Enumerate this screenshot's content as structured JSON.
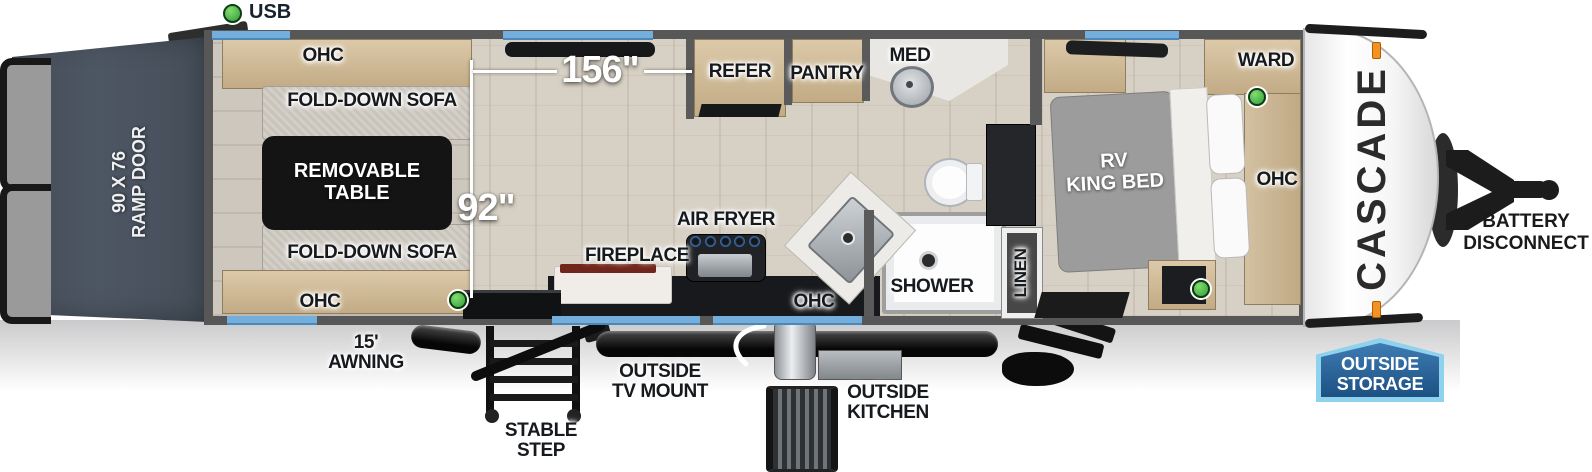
{
  "legend": {
    "usb_label": "USB"
  },
  "dimensions": {
    "main_width": "156\"",
    "garage_width": "92\""
  },
  "exterior": {
    "ramp_door": "90 X 76\nRAMP DOOR",
    "awning": "15' AWNING",
    "stable_step": "STABLE STEP",
    "tv_mount": "OUTSIDE\nTV MOUNT",
    "outside_kitchen": "OUTSIDE\nKITCHEN",
    "outside_storage": "OUTSIDE\nSTORAGE",
    "battery_disconnect": "BATTERY\nDISCONNECT",
    "brand": "CASCADE"
  },
  "garage": {
    "ohc_top": "OHC",
    "ohc_bottom": "OHC",
    "sofa_top": "FOLD-DOWN SOFA",
    "sofa_bottom": "FOLD-DOWN SOFA",
    "table": "REMOVABLE\nTABLE"
  },
  "kitchen": {
    "refer": "REFER",
    "pantry": "PANTRY",
    "fireplace": "FIREPLACE",
    "air_fryer": "AIR FRYER",
    "ohc": "OHC"
  },
  "bathroom": {
    "med": "MED",
    "shower": "SHOWER",
    "linen": "LINEN"
  },
  "bedroom": {
    "bed": "RV\nKING BED",
    "ward": "WARD",
    "ohc": "OHC"
  },
  "colors": {
    "window_blue": "#74aedd",
    "usb_green": "#3fae43",
    "storage_badge_blue": "#2d6ca6",
    "ramp_gray": "#49525d",
    "marker_orange": "#f29222"
  }
}
